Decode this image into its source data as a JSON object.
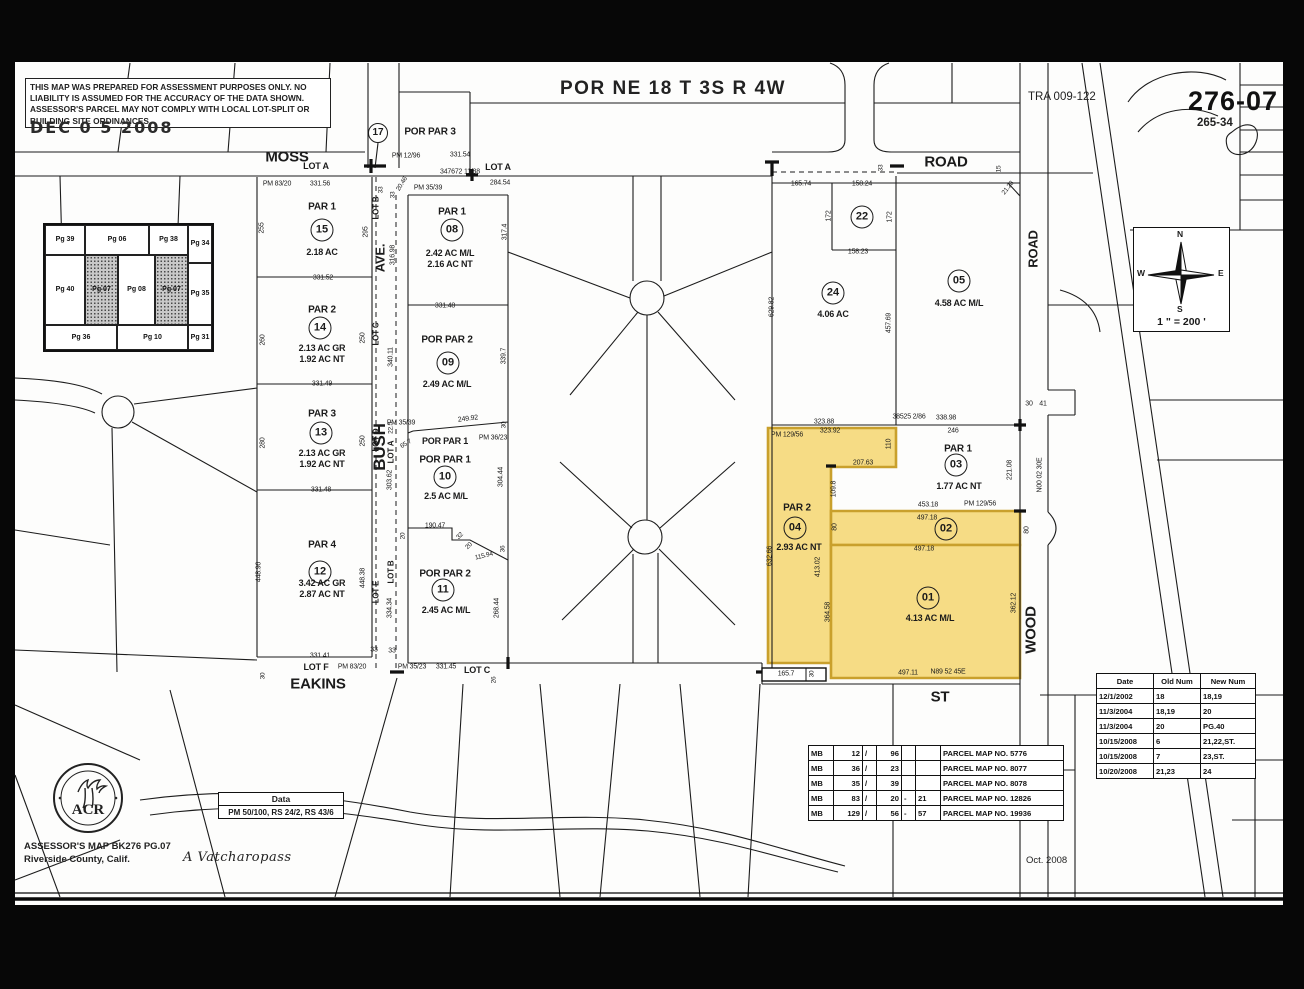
{
  "sheet": {
    "title": "POR NE 18 T 3S R 4W",
    "tra": "TRA 009-122",
    "page_number": "276-07",
    "cross_number": "265-34",
    "disclaimer": "THIS MAP WAS PREPARED FOR ASSESSMENT PURPOSES ONLY.  NO LIABILITY IS ASSUMED FOR THE ACCURACY OF THE DATA SHOWN. ASSESSOR'S PARCEL MAY NOT COMPLY WITH LOCAL LOT-SPLIT OR BUILDING SITE ORDINANCES.",
    "date_stamp": "DEC 0 5 2008",
    "highlight_color": "#f6dc85",
    "highlight_border": "#c9a02c"
  },
  "footer": {
    "assessor_line1": "ASSESSOR'S MAP BK276 PG.07",
    "assessor_line2": "Riverside County, Calif.",
    "signature": "A Vatcharopass",
    "map_date": "Oct. 2008",
    "seal_text": "ACR"
  },
  "data_box": {
    "title": "Data",
    "value": "PM 50/100, RS 24/2, RS 43/6"
  },
  "compass": {
    "n": "N",
    "e": "E",
    "s": "S",
    "w": "W",
    "scale": "1 \" = 200 '"
  },
  "inset_map": {
    "cells": [
      {
        "label": "Pg 39",
        "x": 0,
        "y": 0,
        "w": 40,
        "h": 30,
        "shaded": false
      },
      {
        "label": "Pg 06",
        "x": 40,
        "y": 0,
        "w": 64,
        "h": 30,
        "shaded": false
      },
      {
        "label": "Pg 38",
        "x": 104,
        "y": 0,
        "w": 39,
        "h": 30,
        "shaded": false
      },
      {
        "label": "Pg 34",
        "x": 143,
        "y": 0,
        "w": 24,
        "h": 38,
        "shaded": false
      },
      {
        "label": "Pg 40",
        "x": 0,
        "y": 30,
        "w": 40,
        "h": 70,
        "shaded": false
      },
      {
        "label": "Pg 07",
        "x": 40,
        "y": 30,
        "w": 33,
        "h": 70,
        "shaded": true
      },
      {
        "label": "Pg 08",
        "x": 73,
        "y": 30,
        "w": 37,
        "h": 70,
        "shaded": false
      },
      {
        "label": "Pg 07",
        "x": 110,
        "y": 30,
        "w": 33,
        "h": 70,
        "shaded": true
      },
      {
        "label": "Pg 35",
        "x": 143,
        "y": 38,
        "w": 24,
        "h": 62,
        "shaded": false
      },
      {
        "label": "Pg 36",
        "x": 0,
        "y": 100,
        "w": 72,
        "h": 25,
        "shaded": false
      },
      {
        "label": "Pg 10",
        "x": 72,
        "y": 100,
        "w": 71,
        "h": 25,
        "shaded": false
      },
      {
        "label": "Pg 31",
        "x": 143,
        "y": 100,
        "w": 24,
        "h": 25,
        "shaded": false
      }
    ]
  },
  "mb_table": {
    "rows": [
      {
        "book": "MB",
        "b1": "12",
        "sl": "/",
        "p1": "96",
        "dash": "",
        "p2": "",
        "name": "PARCEL MAP NO. 5776"
      },
      {
        "book": "MB",
        "b1": "36",
        "sl": "/",
        "p1": "23",
        "dash": "",
        "p2": "",
        "name": "PARCEL MAP NO. 8077"
      },
      {
        "book": "MB",
        "b1": "35",
        "sl": "/",
        "p1": "39",
        "dash": "",
        "p2": "",
        "name": "PARCEL MAP NO. 8078"
      },
      {
        "book": "MB",
        "b1": "83",
        "sl": "/",
        "p1": "20",
        "dash": "-",
        "p2": "21",
        "name": "PARCEL MAP NO. 12826"
      },
      {
        "book": "MB",
        "b1": "129",
        "sl": "/",
        "p1": "56",
        "dash": "-",
        "p2": "57",
        "name": "PARCEL MAP NO. 19936"
      }
    ]
  },
  "revision_table": {
    "headers": [
      "Date",
      "Old Num",
      "New Num"
    ],
    "rows": [
      [
        "12/1/2002",
        "18",
        "18,19"
      ],
      [
        "11/3/2004",
        "18,19",
        "20"
      ],
      [
        "11/3/2004",
        "20",
        "PG.40"
      ],
      [
        "10/15/2008",
        "6",
        "21,22,ST."
      ],
      [
        "10/15/2008",
        "7",
        "23,ST."
      ],
      [
        "10/20/2008",
        "21,23",
        "24"
      ]
    ]
  },
  "parcel_circles": [
    {
      "n": "17",
      "x": 378,
      "y": 133,
      "d": 20
    },
    {
      "n": "15",
      "x": 322,
      "y": 230,
      "d": 23
    },
    {
      "n": "14",
      "x": 320,
      "y": 328,
      "d": 23
    },
    {
      "n": "13",
      "x": 321,
      "y": 433,
      "d": 23
    },
    {
      "n": "12",
      "x": 320,
      "y": 572,
      "d": 23
    },
    {
      "n": "08",
      "x": 452,
      "y": 230,
      "d": 23
    },
    {
      "n": "09",
      "x": 448,
      "y": 363,
      "d": 23
    },
    {
      "n": "10",
      "x": 445,
      "y": 477,
      "d": 23
    },
    {
      "n": "11",
      "x": 443,
      "y": 590,
      "d": 23
    },
    {
      "n": "22",
      "x": 862,
      "y": 217,
      "d": 23
    },
    {
      "n": "24",
      "x": 833,
      "y": 293,
      "d": 23
    },
    {
      "n": "05",
      "x": 959,
      "y": 281,
      "d": 23
    },
    {
      "n": "03",
      "x": 956,
      "y": 465,
      "d": 23
    },
    {
      "n": "04",
      "x": 795,
      "y": 528,
      "d": 23
    },
    {
      "n": "02",
      "x": 946,
      "y": 529,
      "d": 23
    },
    {
      "n": "01",
      "x": 928,
      "y": 598,
      "d": 23
    }
  ],
  "map_labels": [
    {
      "t": "MOSS",
      "x": 287,
      "y": 157,
      "s": 15,
      "b": 1,
      "n": "street-label-moss"
    },
    {
      "t": "ROAD",
      "x": 946,
      "y": 162,
      "s": 15,
      "b": 1,
      "n": "street-label-road"
    },
    {
      "t": "ROAD",
      "x": 1033,
      "y": 249,
      "s": 13,
      "b": 1,
      "r": -90,
      "n": "street-label-road-vertical"
    },
    {
      "t": "AVE.",
      "x": 380,
      "y": 258,
      "s": 13,
      "b": 1,
      "r": -90,
      "n": "street-label-ave"
    },
    {
      "t": "BUSH",
      "x": 380,
      "y": 447,
      "s": 17,
      "b": 1,
      "r": -90,
      "n": "street-label-bush"
    },
    {
      "t": "EAKINS",
      "x": 318,
      "y": 684,
      "s": 15,
      "b": 1,
      "n": "street-label-eakins"
    },
    {
      "t": "ST",
      "x": 940,
      "y": 697,
      "s": 15,
      "b": 1,
      "n": "street-label-st"
    },
    {
      "t": "WOOD",
      "x": 1031,
      "y": 630,
      "s": 15,
      "b": 1,
      "r": -90,
      "n": "street-label-wood"
    },
    {
      "t": "POR PAR 3",
      "x": 430,
      "y": 132,
      "s": 10,
      "b": 1
    },
    {
      "t": "PM 12/96",
      "x": 406,
      "y": 156,
      "s": 7
    },
    {
      "t": "331.54",
      "x": 460,
      "y": 155,
      "s": 7
    },
    {
      "t": "347672 11/88",
      "x": 460,
      "y": 172,
      "s": 7
    },
    {
      "t": "LOT A",
      "x": 316,
      "y": 166,
      "s": 9,
      "b": 1
    },
    {
      "t": "LOT A",
      "x": 498,
      "y": 167,
      "s": 9,
      "b": 1
    },
    {
      "t": "PM 83/20",
      "x": 277,
      "y": 184,
      "s": 7
    },
    {
      "t": "331.56",
      "x": 320,
      "y": 184,
      "s": 7
    },
    {
      "t": "284.54",
      "x": 500,
      "y": 183,
      "s": 7
    },
    {
      "t": "PM 35/39",
      "x": 428,
      "y": 188,
      "s": 7
    },
    {
      "t": "20.46",
      "x": 402,
      "y": 184,
      "s": 6.5,
      "r": -58
    },
    {
      "t": "33",
      "x": 381,
      "y": 190,
      "s": 6.5,
      "r": -90
    },
    {
      "t": "33",
      "x": 393,
      "y": 195,
      "s": 6.5,
      "r": -90
    },
    {
      "t": "165.74",
      "x": 801,
      "y": 184,
      "s": 7
    },
    {
      "t": "158.24",
      "x": 862,
      "y": 184,
      "s": 7
    },
    {
      "t": "33",
      "x": 881,
      "y": 168,
      "s": 6.5,
      "r": -90
    },
    {
      "t": "15",
      "x": 999,
      "y": 169,
      "s": 6.5,
      "r": -90
    },
    {
      "t": "21.28",
      "x": 1008,
      "y": 188,
      "s": 6.5,
      "r": -52
    },
    {
      "t": "172",
      "x": 829,
      "y": 216,
      "s": 7,
      "r": -90
    },
    {
      "t": "172",
      "x": 890,
      "y": 217,
      "s": 7,
      "r": -90
    },
    {
      "t": "158.23",
      "x": 858,
      "y": 252,
      "s": 7
    },
    {
      "t": "629.82",
      "x": 772,
      "y": 307,
      "s": 7,
      "r": -90
    },
    {
      "t": "457.69",
      "x": 889,
      "y": 323,
      "s": 7,
      "r": -90
    },
    {
      "t": "4.06 AC",
      "x": 833,
      "y": 314,
      "s": 9,
      "b": 1
    },
    {
      "t": "4.58 AC M/L",
      "x": 959,
      "y": 303,
      "s": 9,
      "b": 1
    },
    {
      "t": "PAR 1",
      "x": 322,
      "y": 207,
      "s": 10,
      "b": 1
    },
    {
      "t": "2.18 AC",
      "x": 322,
      "y": 252,
      "s": 9,
      "b": 1
    },
    {
      "t": "255",
      "x": 262,
      "y": 228,
      "s": 7,
      "r": -90
    },
    {
      "t": "295",
      "x": 366,
      "y": 232,
      "s": 7,
      "r": -90
    },
    {
      "t": "331.52",
      "x": 323,
      "y": 278,
      "s": 7
    },
    {
      "t": "PAR 2",
      "x": 322,
      "y": 310,
      "s": 10,
      "b": 1
    },
    {
      "t": "2.13 AC GR",
      "x": 322,
      "y": 348,
      "s": 9,
      "b": 1
    },
    {
      "t": "1.92 AC NT",
      "x": 322,
      "y": 359,
      "s": 9,
      "b": 1
    },
    {
      "t": "260",
      "x": 263,
      "y": 340,
      "s": 7,
      "r": -90
    },
    {
      "t": "250",
      "x": 363,
      "y": 338,
      "s": 7,
      "r": -90
    },
    {
      "t": "331.49",
      "x": 322,
      "y": 384,
      "s": 7
    },
    {
      "t": "PAR 3",
      "x": 322,
      "y": 414,
      "s": 10,
      "b": 1
    },
    {
      "t": "2.13 AC GR",
      "x": 322,
      "y": 453,
      "s": 9,
      "b": 1
    },
    {
      "t": "1.92 AC NT",
      "x": 322,
      "y": 464,
      "s": 9,
      "b": 1
    },
    {
      "t": "280",
      "x": 263,
      "y": 443,
      "s": 7,
      "r": -90
    },
    {
      "t": "250",
      "x": 363,
      "y": 441,
      "s": 7,
      "r": -90
    },
    {
      "t": "331.48",
      "x": 321,
      "y": 490,
      "s": 7
    },
    {
      "t": "PAR 4",
      "x": 322,
      "y": 545,
      "s": 10,
      "b": 1
    },
    {
      "t": "3.42 AC GR",
      "x": 322,
      "y": 583,
      "s": 9,
      "b": 1
    },
    {
      "t": "2.87 AC NT",
      "x": 322,
      "y": 594,
      "s": 9,
      "b": 1
    },
    {
      "t": "448.96",
      "x": 259,
      "y": 572,
      "s": 7,
      "r": -90
    },
    {
      "t": "448.38",
      "x": 363,
      "y": 578,
      "s": 7,
      "r": -90
    },
    {
      "t": "331.41",
      "x": 320,
      "y": 656,
      "s": 7
    },
    {
      "t": "LOT F",
      "x": 316,
      "y": 667,
      "s": 9,
      "b": 1
    },
    {
      "t": "PM 83/20",
      "x": 352,
      "y": 667,
      "s": 7
    },
    {
      "t": "30",
      "x": 263,
      "y": 676,
      "s": 6.5,
      "r": -90
    },
    {
      "t": "33",
      "x": 374,
      "y": 650,
      "s": 7
    },
    {
      "t": "33",
      "x": 392,
      "y": 651,
      "s": 7
    },
    {
      "t": "PM 35/23",
      "x": 412,
      "y": 667,
      "s": 7
    },
    {
      "t": "331.45",
      "x": 446,
      "y": 667,
      "s": 7
    },
    {
      "t": "LOT C",
      "x": 477,
      "y": 670,
      "s": 9,
      "b": 1
    },
    {
      "t": "26",
      "x": 494,
      "y": 680,
      "s": 6.5,
      "r": -90
    },
    {
      "t": "PAR 1",
      "x": 452,
      "y": 212,
      "s": 10,
      "b": 1
    },
    {
      "t": "2.42 AC M/L",
      "x": 450,
      "y": 253,
      "s": 9,
      "b": 1
    },
    {
      "t": "2.16 AC NT",
      "x": 450,
      "y": 264,
      "s": 9,
      "b": 1
    },
    {
      "t": "317.4",
      "x": 505,
      "y": 232,
      "s": 7,
      "r": -90
    },
    {
      "t": "316.98",
      "x": 393,
      "y": 255,
      "s": 7,
      "r": -90
    },
    {
      "t": "331.48",
      "x": 445,
      "y": 306,
      "s": 7
    },
    {
      "t": "POR PAR 2",
      "x": 447,
      "y": 340,
      "s": 10,
      "b": 1
    },
    {
      "t": "2.49 AC M/L",
      "x": 447,
      "y": 384,
      "s": 9,
      "b": 1
    },
    {
      "t": "339.7",
      "x": 504,
      "y": 356,
      "s": 7,
      "r": -90
    },
    {
      "t": "340.11",
      "x": 391,
      "y": 357,
      "s": 7,
      "r": -90
    },
    {
      "t": "303.62",
      "x": 390,
      "y": 480,
      "s": 7,
      "r": -90
    },
    {
      "t": "334.34",
      "x": 390,
      "y": 608,
      "s": 7,
      "r": -90
    },
    {
      "t": "LOT B",
      "x": 376,
      "y": 208,
      "s": 8,
      "b": 1,
      "r": -90
    },
    {
      "t": "LOT C",
      "x": 376,
      "y": 334,
      "s": 8,
      "b": 1,
      "r": -90
    },
    {
      "t": "LOT D",
      "x": 376,
      "y": 440,
      "s": 8,
      "b": 1,
      "r": -90
    },
    {
      "t": "LOT E",
      "x": 376,
      "y": 592,
      "s": 8,
      "b": 1,
      "r": -90
    },
    {
      "t": "22.5",
      "x": 391,
      "y": 428,
      "s": 6.5,
      "r": -90
    },
    {
      "t": "LOT A",
      "x": 391,
      "y": 452,
      "s": 8,
      "b": 1,
      "r": -90
    },
    {
      "t": "LOT B",
      "x": 391,
      "y": 572,
      "s": 8,
      "b": 1,
      "r": -90
    },
    {
      "t": "PM 35/39",
      "x": 401,
      "y": 423,
      "s": 7
    },
    {
      "t": "249.92",
      "x": 468,
      "y": 419,
      "s": 7,
      "r": -7
    },
    {
      "t": "30",
      "x": 504,
      "y": 425,
      "s": 6.5,
      "r": -90
    },
    {
      "t": "PM 36/23",
      "x": 493,
      "y": 438,
      "s": 7
    },
    {
      "t": "POR PAR 1",
      "x": 445,
      "y": 441,
      "s": 9,
      "b": 1
    },
    {
      "t": "65.7",
      "x": 406,
      "y": 444,
      "s": 6.5,
      "r": -32
    },
    {
      "t": "POR PAR 1",
      "x": 445,
      "y": 460,
      "s": 10,
      "b": 1
    },
    {
      "t": "2.5 AC M/L",
      "x": 446,
      "y": 496,
      "s": 9,
      "b": 1
    },
    {
      "t": "304.44",
      "x": 501,
      "y": 477,
      "s": 7,
      "r": -90
    },
    {
      "t": "190.47",
      "x": 435,
      "y": 526,
      "s": 7
    },
    {
      "t": "20",
      "x": 403,
      "y": 536,
      "s": 6.5,
      "r": -90
    },
    {
      "t": "32",
      "x": 460,
      "y": 536,
      "s": 6.5,
      "r": -45
    },
    {
      "t": "20",
      "x": 469,
      "y": 546,
      "s": 6.5,
      "r": -45
    },
    {
      "t": "36",
      "x": 503,
      "y": 549,
      "s": 6.5,
      "r": -90
    },
    {
      "t": "115.94",
      "x": 484,
      "y": 556,
      "s": 6.5,
      "r": -14
    },
    {
      "t": "POR PAR 2",
      "x": 445,
      "y": 574,
      "s": 10,
      "b": 1
    },
    {
      "t": "2.45 AC M/L",
      "x": 446,
      "y": 610,
      "s": 9,
      "b": 1
    },
    {
      "t": "268.44",
      "x": 497,
      "y": 608,
      "s": 7,
      "r": -90
    },
    {
      "t": "38525 2/86",
      "x": 909,
      "y": 417,
      "s": 7
    },
    {
      "t": "338.98",
      "x": 946,
      "y": 418,
      "s": 7
    },
    {
      "t": "323.88",
      "x": 824,
      "y": 422,
      "s": 7
    },
    {
      "t": "30",
      "x": 1029,
      "y": 404,
      "s": 7
    },
    {
      "t": "41",
      "x": 1043,
      "y": 404,
      "s": 7
    },
    {
      "t": "PM 129/56",
      "x": 787,
      "y": 435,
      "s": 7
    },
    {
      "t": "323.92",
      "x": 830,
      "y": 431,
      "s": 7
    },
    {
      "t": "110",
      "x": 889,
      "y": 444,
      "s": 7,
      "r": -90
    },
    {
      "t": "207.63",
      "x": 863,
      "y": 463,
      "s": 7
    },
    {
      "t": "109.8",
      "x": 834,
      "y": 489,
      "s": 7,
      "r": -90
    },
    {
      "t": "PAR 2",
      "x": 797,
      "y": 508,
      "s": 10,
      "b": 1
    },
    {
      "t": "2.93 AC NT",
      "x": 799,
      "y": 547,
      "s": 9,
      "b": 1
    },
    {
      "t": "632.66",
      "x": 770,
      "y": 556,
      "s": 7,
      "r": -90
    },
    {
      "t": "413.02",
      "x": 818,
      "y": 567,
      "s": 7,
      "r": -90
    },
    {
      "t": "364.58",
      "x": 828,
      "y": 612,
      "s": 7,
      "r": -90
    },
    {
      "t": "PAR 1",
      "x": 958,
      "y": 449,
      "s": 10,
      "b": 1
    },
    {
      "t": "1.77 AC NT",
      "x": 959,
      "y": 486,
      "s": 9,
      "b": 1
    },
    {
      "t": "246",
      "x": 953,
      "y": 431,
      "s": 7
    },
    {
      "t": "221.08",
      "x": 1010,
      "y": 470,
      "s": 7,
      "r": -90
    },
    {
      "t": "N00 02 30E",
      "x": 1040,
      "y": 475,
      "s": 7,
      "r": -90
    },
    {
      "t": "453.18",
      "x": 928,
      "y": 505,
      "s": 7
    },
    {
      "t": "PM 129/56",
      "x": 980,
      "y": 504,
      "s": 7
    },
    {
      "t": "497.18",
      "x": 927,
      "y": 518,
      "s": 7
    },
    {
      "t": "80",
      "x": 835,
      "y": 527,
      "s": 7,
      "r": -90
    },
    {
      "t": "80",
      "x": 1027,
      "y": 530,
      "s": 7,
      "r": -90
    },
    {
      "t": "497.18",
      "x": 924,
      "y": 549,
      "s": 7
    },
    {
      "t": "4.13 AC M/L",
      "x": 930,
      "y": 618,
      "s": 9,
      "b": 1
    },
    {
      "t": "362.12",
      "x": 1014,
      "y": 603,
      "s": 7,
      "r": -90
    },
    {
      "t": "497.11",
      "x": 908,
      "y": 673,
      "s": 7
    },
    {
      "t": "N89 52 45E",
      "x": 948,
      "y": 672,
      "s": 7
    },
    {
      "t": "165.7",
      "x": 786,
      "y": 674,
      "s": 7
    },
    {
      "t": "30",
      "x": 812,
      "y": 674,
      "s": 6.5,
      "r": -90
    }
  ]
}
